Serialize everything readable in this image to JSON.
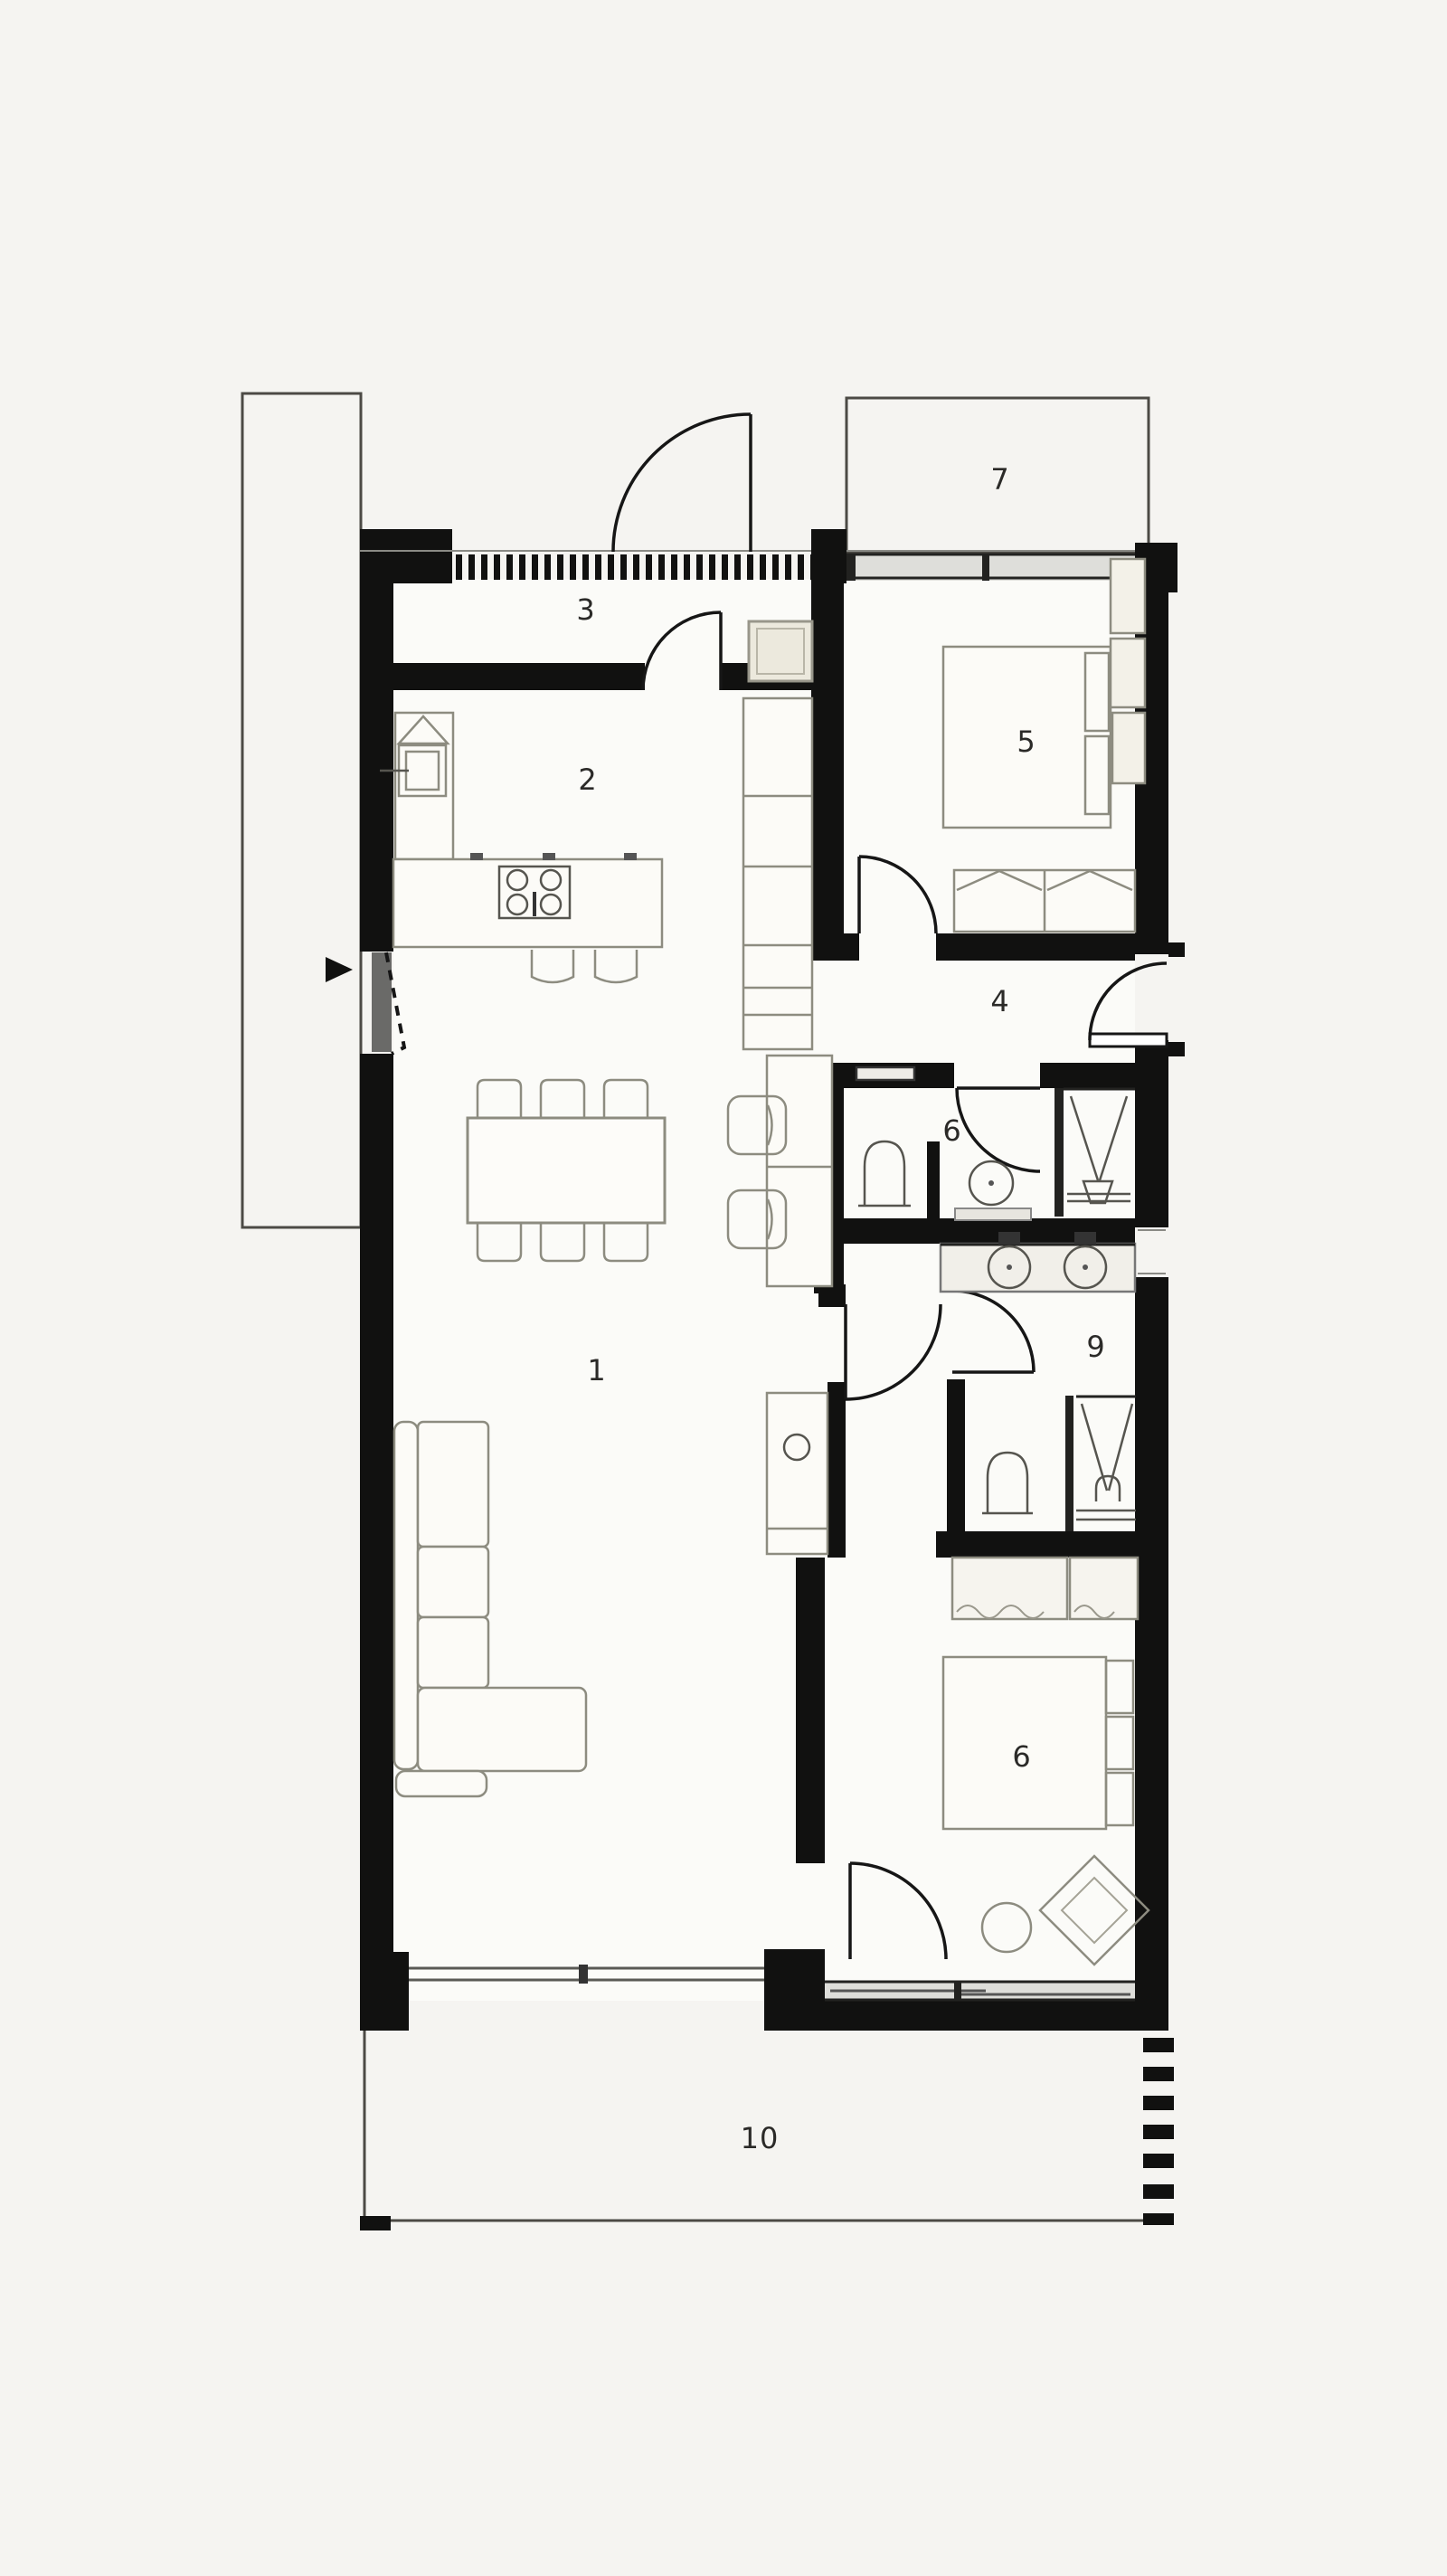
{
  "document": {
    "type": "architectural floor plan, top view, black walls on off-white paper",
    "background_color": "#f5f4f1",
    "wall_color": "#111110",
    "furniture_line_color": "#8d8c80",
    "label_color": "#2b2a28"
  },
  "rooms": {
    "living_room": {
      "label": "1"
    },
    "kitchen": {
      "label": "2"
    },
    "entry_hall": {
      "label": "3"
    },
    "hallway": {
      "label": "4"
    },
    "bedroom_main": {
      "label": "5"
    },
    "bathroom": {
      "label": "6"
    },
    "terrace_top": {
      "label": "7"
    },
    "bedroom_second": {
      "label": "6"
    },
    "bathroom_ensuite": {
      "label": "9"
    },
    "terrace_bottom": {
      "label": "10"
    }
  },
  "symbols": [
    "entry-arrow",
    "hinged-door-arcs",
    "hatched-facade-band",
    "window-glazing-bands",
    "kitchen-island-with-cooktop",
    "kitchen-sink",
    "tall-cabinet-column",
    "bar-stools",
    "dining-table-six-chairs",
    "two-armchairs",
    "sectional-sofa",
    "double-bed-top",
    "double-bed-bottom",
    "wardrobes",
    "toilets",
    "showers",
    "double-vanity-sinks",
    "single-vanity-sink",
    "ottoman",
    "diamond-lounge-chair",
    "dashed-property-line"
  ]
}
